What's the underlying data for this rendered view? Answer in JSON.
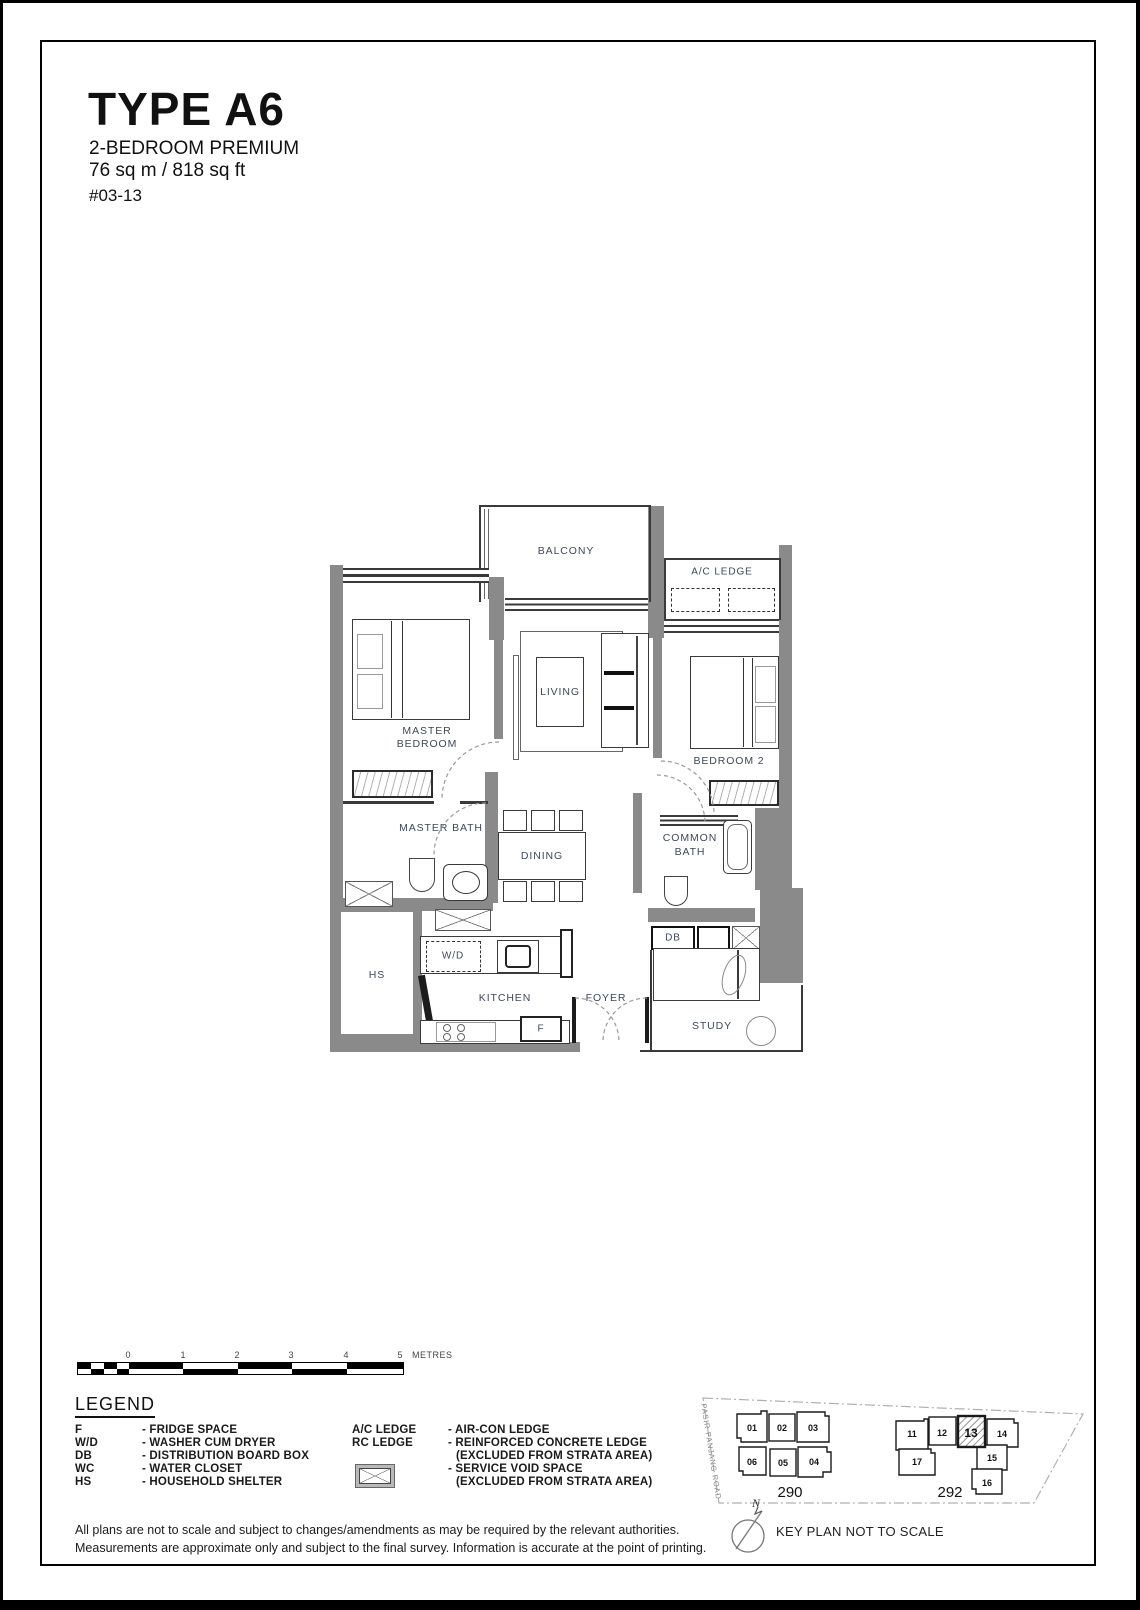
{
  "header": {
    "title": "TYPE A6",
    "subtitle": "2-BEDROOM PREMIUM",
    "area": "76 sq m / 818 sq ft",
    "unit_number": "#03-13"
  },
  "plan": {
    "labels": {
      "balcony": "BALCONY",
      "ac_ledge": "A/C LEDGE",
      "living": "LIVING",
      "master_line1": "MASTER",
      "master_line2": "BEDROOM",
      "bedroom2": "BEDROOM 2",
      "master_bath": "MASTER BATH",
      "dining": "DINING",
      "common_line1": "COMMON",
      "common_line2": "BATH",
      "db": "DB",
      "wd": "W/D",
      "hs": "HS",
      "kitchen": "KITCHEN",
      "foyer": "FOYER",
      "fridge": "F",
      "study": "STUDY"
    }
  },
  "scale_bar": {
    "ticks": [
      "0",
      "1",
      "2",
      "3",
      "4",
      "5"
    ],
    "unit_label": "METRES"
  },
  "legend": {
    "title": "LEGEND",
    "left": [
      {
        "abbr": "F",
        "desc": "- FRIDGE SPACE"
      },
      {
        "abbr": "W/D",
        "desc": "- WASHER CUM DRYER"
      },
      {
        "abbr": "DB",
        "desc": "- DISTRIBUTION BOARD BOX"
      },
      {
        "abbr": "WC",
        "desc": "- WATER CLOSET"
      },
      {
        "abbr": "HS",
        "desc": "- HOUSEHOLD SHELTER"
      }
    ],
    "right": [
      {
        "abbr": "A/C LEDGE",
        "desc": "- AIR-CON LEDGE",
        "desc2": ""
      },
      {
        "abbr": "RC LEDGE",
        "desc": "- REINFORCED CONCRETE LEDGE",
        "desc2": "(EXCLUDED FROM STRATA AREA)"
      },
      {
        "abbr": "",
        "desc": "- SERVICE VOID SPACE",
        "desc2": "(EXCLUDED FROM STRATA AREA)"
      }
    ]
  },
  "key_plan": {
    "road": "PASIR PANJANG ROAD",
    "block_290": {
      "label": "290",
      "units": [
        "01",
        "02",
        "03",
        "06",
        "05",
        "04"
      ]
    },
    "block_292": {
      "label": "292",
      "units": [
        "11",
        "12",
        "13",
        "14",
        "17",
        "15",
        "16"
      ]
    },
    "highlighted_unit": "13",
    "north": "N",
    "caption": "KEY PLAN NOT TO SCALE"
  },
  "disclaimer": {
    "line1": "All plans are not to scale and subject to changes/amendments as may be required by the relevant authorities.",
    "line2": "Measurements are approximate only and subject to the final survey. Information is accurate at the point of printing."
  },
  "colors": {
    "wall": "#8a8a8a",
    "label": "#3f4857",
    "line": "#3a3a3a"
  }
}
